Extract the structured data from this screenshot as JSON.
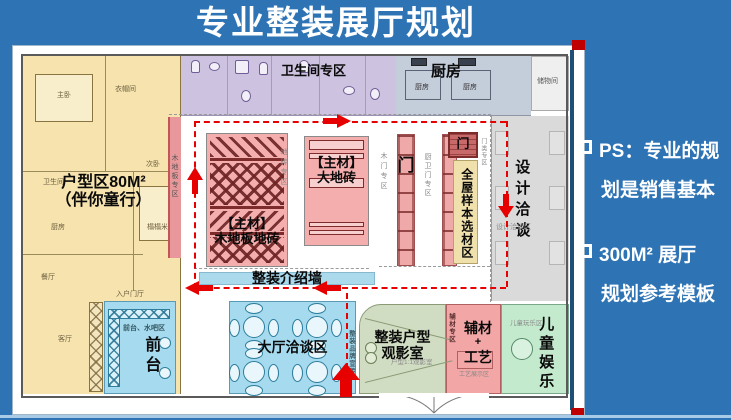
{
  "title": "专业整装展厅规划",
  "notes": {
    "n1_line1": "PS：专业的规",
    "n1_line2": "划是销售基本",
    "n2_line1": "300M² 展厅",
    "n2_line2": "规划参考模板"
  },
  "plan": {
    "unit_zone_title": "户型区80M²",
    "unit_zone_subtitle": "（伴你童行）",
    "rooms": {
      "master": "主卧",
      "cloak": "衣帽间",
      "second": "次卧",
      "bath": "卫生间",
      "kitchen": "厨房",
      "dining": "餐厅",
      "living": "客厅",
      "tatami": "榻榻米",
      "foyer": "入户门厅"
    },
    "bath_zone": "卫生间专区",
    "kitchen_zone": "厨房",
    "kitchen_room": "厨房",
    "storage": "储物间",
    "wood_floor_strip": "木地板专区",
    "material_tag": "【主材】",
    "wood_block": "木地板地砖",
    "tile_strip": "地砖专区",
    "tile_block": "大地砖",
    "wood_door_strip": "木门专区",
    "door": "门",
    "kb_door_strip": "厨卫门专区",
    "door_type_strip": "门类专区",
    "sample_zone": "全屋样本选材区",
    "design_zone": "设计洽谈",
    "design_zone_faint": "设计洽谈区",
    "intro_wall": "整装介绍墙",
    "front_desk_caption": "前台、水吧区",
    "front_desk": "前台",
    "hall_zone": "大厅洽谈区",
    "brand_strip": "整装品牌宣传",
    "viewing_line1": "整装户型",
    "viewing_line2": "观影室",
    "viewing_faint": "户型1:1观影室",
    "aux_strip": "辅材专区",
    "aux_line1": "辅材",
    "aux_plus": "+",
    "aux_line2": "工艺",
    "aux_faint": "工艺展示区",
    "kids_zone": "儿童娱乐",
    "kids_faint": "儿童玩乐区"
  },
  "colors": {
    "slide_bg": "#2E74B5",
    "path_red": "#E60000",
    "zone_pink": "#F3ACAC",
    "zone_blue": "#A6DBEF",
    "zone_green": "#C3EACD",
    "zone_sage": "#D1DDC2",
    "zone_yellow": "#F6E3AE",
    "zone_purple": "#CDC2DF",
    "navy_bar": "#1F4E79"
  }
}
